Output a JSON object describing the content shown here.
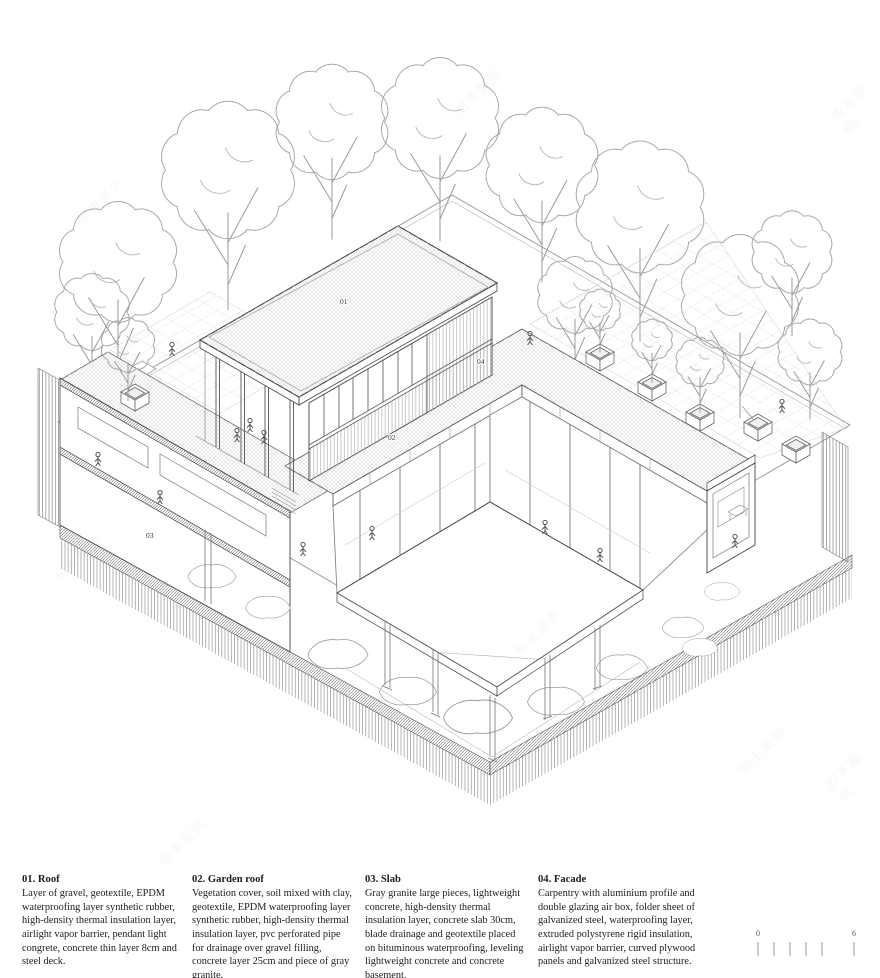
{
  "drawing_labels": {
    "l01": "01",
    "l02": "02",
    "l03": "03",
    "l04": "04"
  },
  "legend": {
    "items": [
      {
        "title": "01. Roof",
        "body": "Layer of gravel, geotextile, EPDM waterproofing layer synthetic rubber, high-density thermal insulation layer, airlight vapor barrier, pendant light congrete, concrete thin layer 8cm and steel deck."
      },
      {
        "title": "02. Garden roof",
        "body": "Vegetation cover, soil mixed with clay, geotextile, EPDM waterproofing layer synthetic rubber, high-density thermal insulation layer, pvc perforated pipe for drainage over gravel filling, concrete layer 25cm and piece of gray granite."
      },
      {
        "title": "03. Slab",
        "body": "Gray granite large pieces, lightweight concrete, high-density thermal insulation layer, concrete slab 30cm, blade drainage and geotextile placed on bituminous waterproofing, leveling lightweight concrete and concrete basement."
      },
      {
        "title": "04. Facade",
        "body": "Carpentry with aluminium profile and double glazing air box, folder sheet of galvanized steel, waterproofing layer, extruded polystyrene rigid insulation, airlight vapor barrier, curved plywood panels and galvanized steel structure."
      }
    ]
  },
  "scale_bar": {
    "start": "0",
    "end": "6"
  },
  "watermark": {
    "text": "知末案例"
  }
}
